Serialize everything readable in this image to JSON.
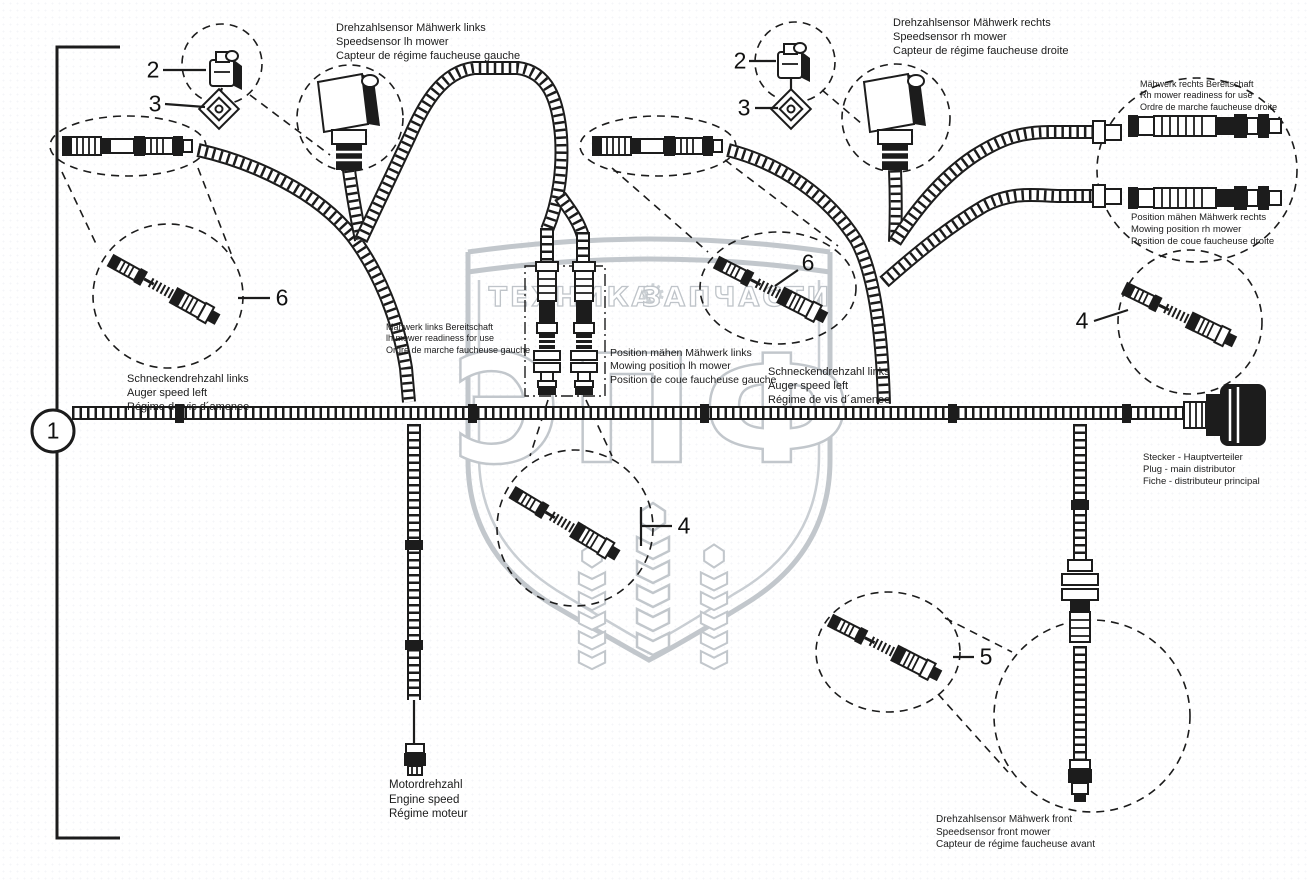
{
  "colors": {
    "line": "#1c1c1c",
    "watermark": "#c2c7cc",
    "background": "#ffffff"
  },
  "callouts": {
    "one": "1",
    "two": "2",
    "three": "3",
    "four": "4",
    "five": "5",
    "six": "6"
  },
  "watermark": {
    "tech": "ТЕХНИКА",
    "parts": "ЗАПЧАСТИ",
    "gear": "⚙",
    "brand": "ЭПФ"
  },
  "labels": {
    "sensor_left": {
      "de": "Drehzahlsensor Mähwerk links",
      "en": "Speedsensor lh mower",
      "fr": "Capteur de régime faucheuse gauche"
    },
    "sensor_right": {
      "de": "Drehzahlsensor Mähwerk rechts",
      "en": "Speedsensor rh mower",
      "fr": "Capteur de régime faucheuse droite"
    },
    "ready_right": {
      "de": "Mähwerk rechts Bereitschaft",
      "en": "Rh mower readiness for use",
      "fr": "Ordre de marche faucheuse droite"
    },
    "position_right": {
      "de": "Position mähen Mähwerk rechts",
      "en": "Mowing position rh mower",
      "fr": "Position de coue faucheuse droite"
    },
    "ready_left": {
      "de": "Mähwerk links Bereitschaft",
      "en": "lh mower readiness for use",
      "fr": "Ordre de marche faucheuse gauche"
    },
    "position_left": {
      "de": "Position mähen Mähwerk links",
      "en": "Mowing position lh mower",
      "fr": "Position de coue faucheuse gauche"
    },
    "auger_left": {
      "de": "Schneckendrehzahl links",
      "en": "Auger speed left",
      "fr": "Régime de vis d´amenee"
    },
    "auger_center": {
      "de": "Schneckendrehzahl links",
      "en": "Auger speed left",
      "fr": "Régime de vis d´amenee"
    },
    "distributor": {
      "de": "Stecker - Hauptverteiler",
      "en": "Plug - main distributor",
      "fr": "Fiche - distributeur principal"
    },
    "engine": {
      "de": "Motordrehzahl",
      "en": "Engine speed",
      "fr": "Régime moteur"
    },
    "sensor_front": {
      "de": "Drehzahlsensor Mähwerk front",
      "en": "Speedsensor front mower",
      "fr": "Capteur de régime faucheuse avant"
    }
  }
}
